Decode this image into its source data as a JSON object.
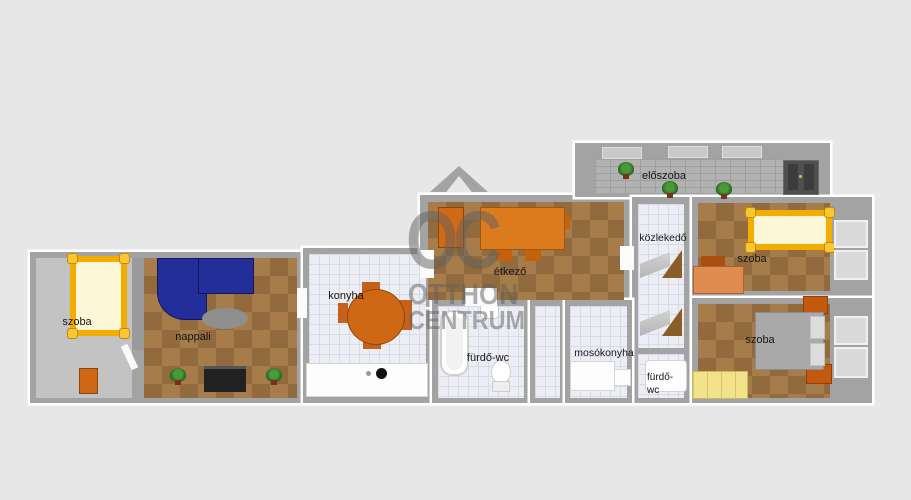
{
  "watermark": {
    "monogram": "OC",
    "line1": "OTTHON",
    "line2": "CENTRUM",
    "roof_icon": "chevron-roof-icon"
  },
  "rooms": {
    "szoba_left": {
      "label": "szoba"
    },
    "nappali": {
      "label": "nappali"
    },
    "konyha": {
      "label": "konyha"
    },
    "etkezo": {
      "label": "étkező"
    },
    "furdo_wc": {
      "label": "fürdő-wc"
    },
    "mosokonyha": {
      "label": "mosókonyha"
    },
    "kozlekedo": {
      "label": "közlekedő"
    },
    "eloszoba": {
      "label": "előszoba"
    },
    "szoba_top_right": {
      "label": "szoba"
    },
    "szoba_bottom_right": {
      "label": "szoba"
    },
    "furdo_wc_small": {
      "label_line1": "fürdő-",
      "label_line2": "wc"
    }
  },
  "colors": {
    "background": "#e7e7e7",
    "wall": "#a3a3a3",
    "outline": "#ffffff",
    "floor_gray": "#c3c3c3",
    "parquet": "#a57c4a",
    "parquet_dark": "#916a3d",
    "tile": "#eceef4",
    "tile_line": "#d7dbe7",
    "stone": "#b2b2b2",
    "stone_line": "#9f9f9f",
    "accent_orange": "#cf6815",
    "orange_light": "#e08b4f",
    "sofa_blue": "#232e9b",
    "bed_gold": "#f2ae00",
    "bed_mattress": "#fdf7d8",
    "bed_gray": "#a9a9a9",
    "wardrobe_yellow": "#f2e38a",
    "tv_dark": "#222222",
    "door_dark": "#4f4f4f",
    "door_wood": "#8a5e28",
    "plant_green": "#236020",
    "label": "#161616",
    "watermark": "rgba(95,95,95,0.5)"
  }
}
